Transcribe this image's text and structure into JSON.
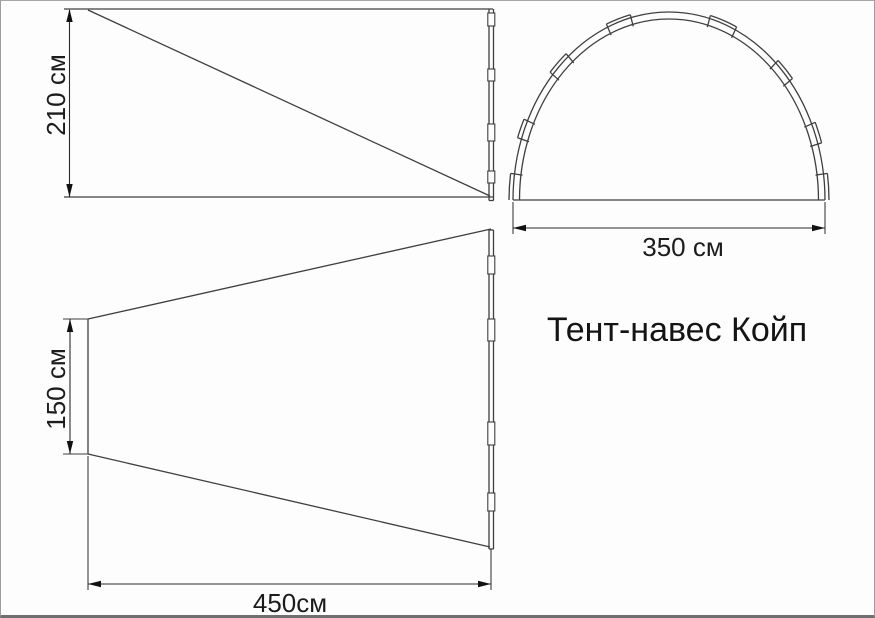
{
  "title": "Тент-навес Койп",
  "views": {
    "side_view": {
      "name": "side view",
      "height_label": "210 см"
    },
    "front_view": {
      "name": "front arch view",
      "width_label": "350 см"
    },
    "top_view": {
      "name": "top view",
      "rear_width_label": "150 см",
      "length_label": "450см"
    }
  },
  "colors": {
    "line": "#3f3f3f",
    "text": "#1c1c1c",
    "background": "#fdfdfd",
    "border": "#9d9d9d"
  }
}
